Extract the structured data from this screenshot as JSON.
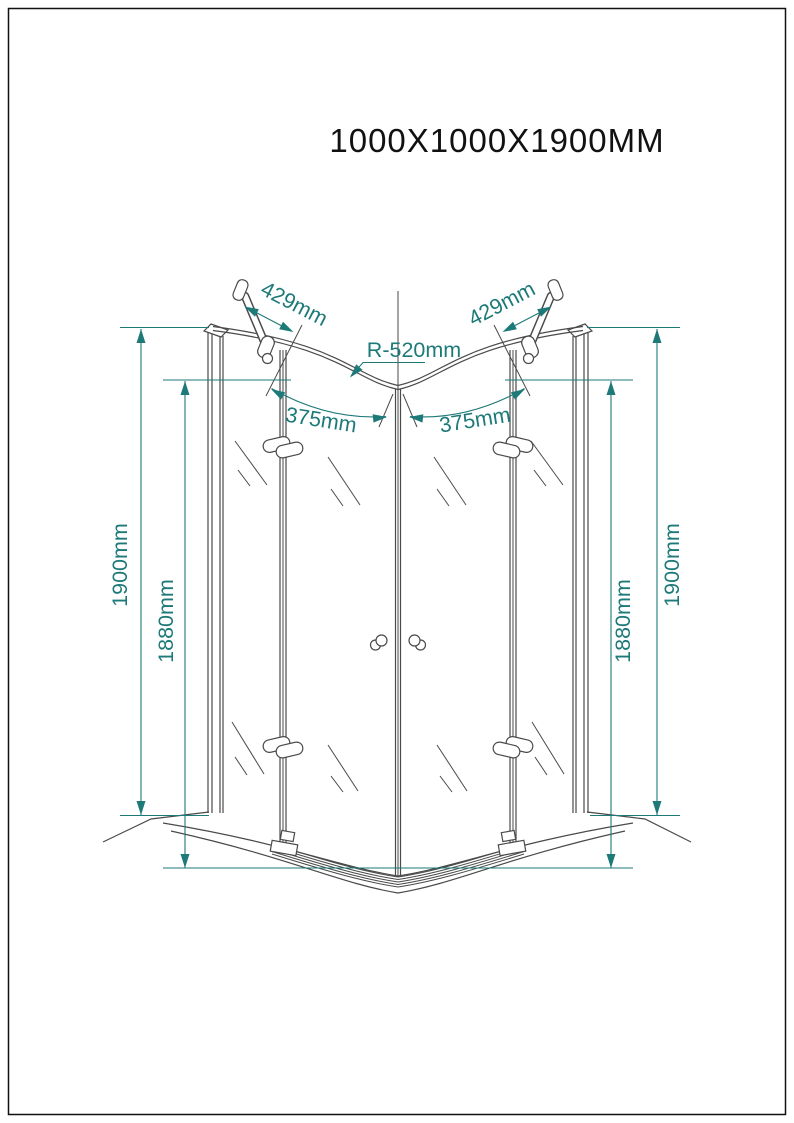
{
  "sheet": {
    "title": "1000X1000X1900MM"
  },
  "colors": {
    "dimension_teal": "#1d7a78",
    "drawing_line": "#4a4a4a",
    "title_text": "#111111",
    "background": "#ffffff"
  },
  "dimensions": {
    "support_bar_left": "429mm",
    "support_bar_right": "429mm",
    "radius": "R-520mm",
    "door_width_left": "375mm",
    "door_width_right": "375mm",
    "total_height_left": "1900mm",
    "glass_height_left": "1880mm",
    "glass_height_right": "1880mm",
    "total_height_right": "1900mm"
  }
}
